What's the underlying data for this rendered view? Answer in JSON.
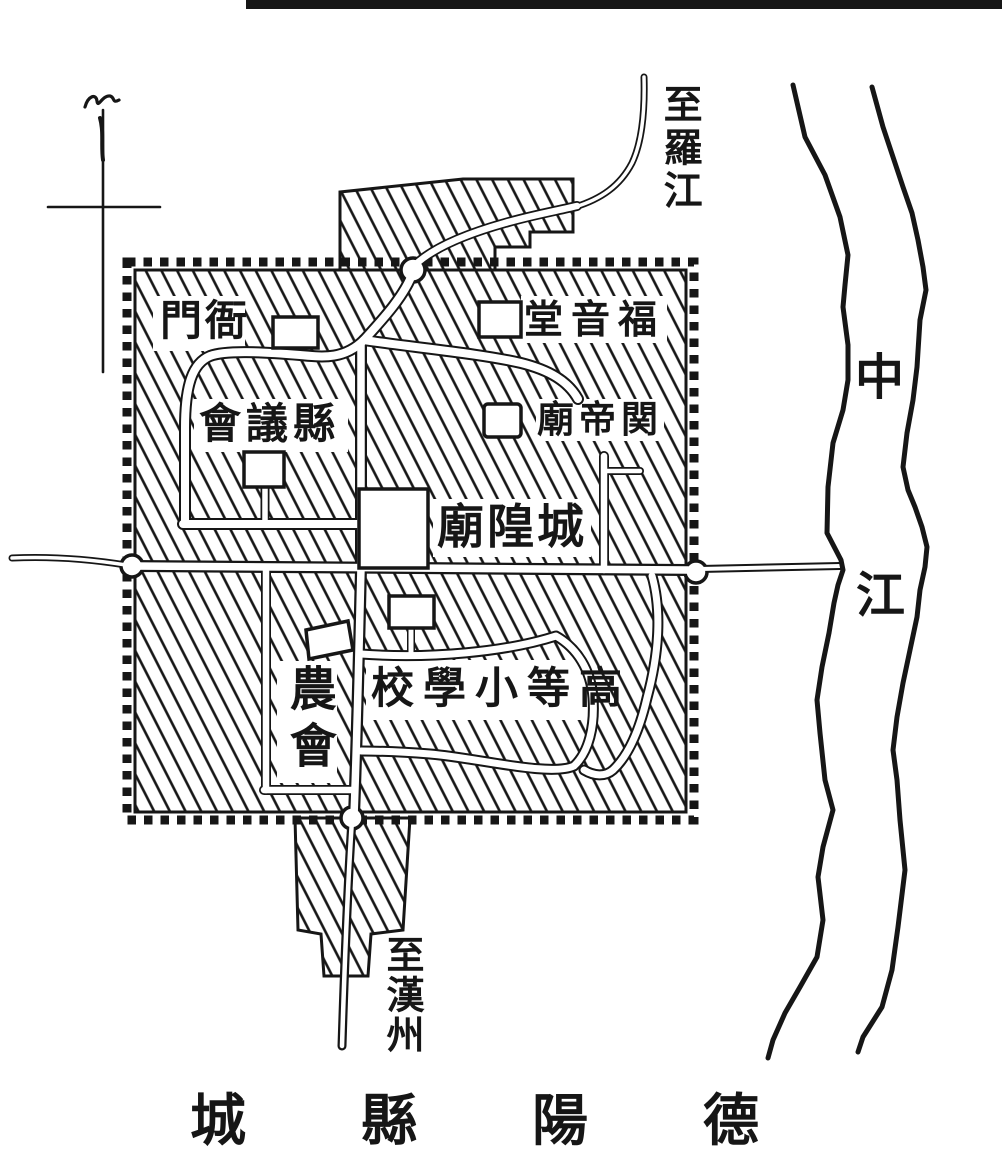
{
  "colors": {
    "ink": "#161616",
    "paper": "#ffffff"
  },
  "city_labels": {
    "yamen": "門衙",
    "county_council": "會議縣",
    "gospel_hall": "堂音福",
    "guandi_temple": "廟帝関",
    "city_god_temple": "廟隍城",
    "higher_primary_school": "校學小等高",
    "farmers_association": "農會"
  },
  "route_labels": {
    "to_luojiang": "至羅江",
    "to_hanzhou": "至漢州"
  },
  "river_label": {
    "chars": [
      "中",
      "江"
    ]
  },
  "map_title": {
    "text": "城縣陽德"
  },
  "icons": {
    "compass": "north-compass-cross"
  }
}
